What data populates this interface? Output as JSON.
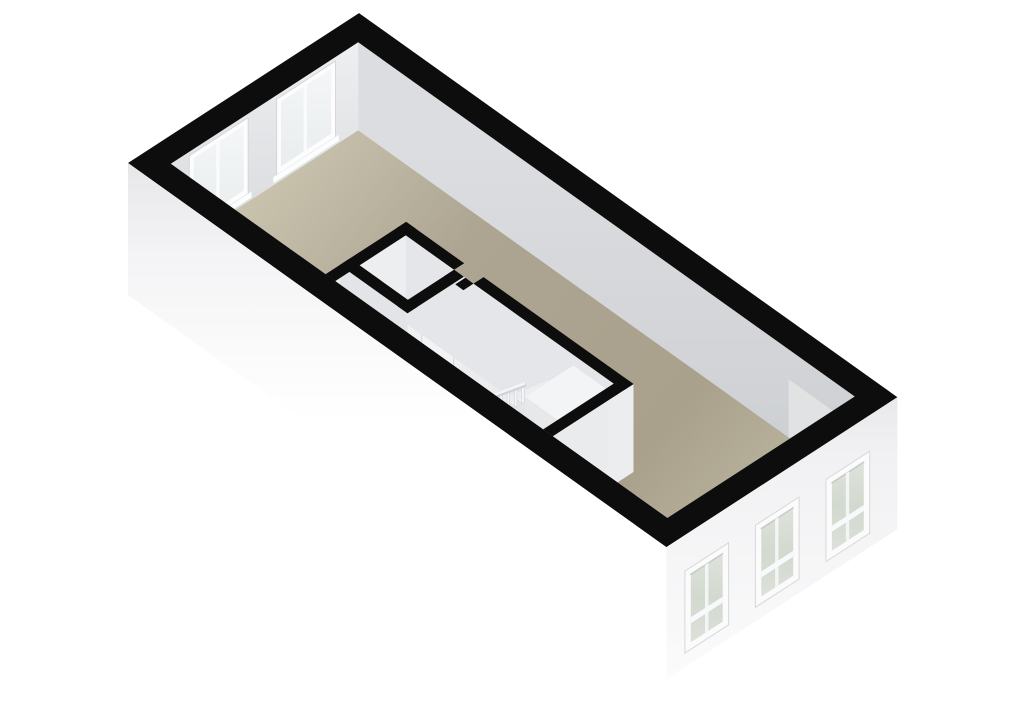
{
  "scene": {
    "kind": "floorplan-3d-render",
    "width": 1024,
    "height": 724,
    "background": "#ffffff",
    "colors": {
      "wall_cut_black": "#0d0d0d",
      "floor_tan": "#a9a18c",
      "floor_tan_light": "#cac4af",
      "interior_wall_light": "#eceef0",
      "interior_wall_shade": "#e2e4e7",
      "nw_face_top": "#eceef0",
      "nw_face_bottom": "#d7d9dc",
      "ne_face_top": "#dadcde",
      "ne_face_bottom": "#cdd0d3",
      "exterior_white": "#fbfbfc",
      "window_frame": "#fbfbfc",
      "glass_green": "#d3dad0",
      "glass_pale": "#f0f3f4",
      "stair_tread": "#f2f3f5",
      "stair_side": "#e3e5e8",
      "door_outline": "#c6c8cb"
    },
    "gradients": [
      {
        "id": "g_floor",
        "units": "userSpaceOnUse",
        "x1": 300,
        "y1": 120,
        "x2": 760,
        "y2": 500,
        "stops": [
          [
            0,
            "#cac4af"
          ],
          [
            0.35,
            "#ada592"
          ],
          [
            0.8,
            "#a9a18c"
          ],
          [
            1,
            "#b8b19c"
          ]
        ]
      },
      {
        "id": "g_nwface",
        "units": "userSpaceOnUse",
        "x1": 260,
        "y1": 50,
        "x2": 260,
        "y2": 250,
        "stops": [
          [
            0,
            "#eceef0"
          ],
          [
            1,
            "#d7d9dc"
          ]
        ]
      },
      {
        "id": "g_neface",
        "units": "userSpaceOnUse",
        "x1": 600,
        "y1": 150,
        "x2": 600,
        "y2": 490,
        "stops": [
          [
            0,
            "#dbdde0"
          ],
          [
            0.6,
            "#d2d4d7"
          ],
          [
            1,
            "#cbced1"
          ]
        ]
      },
      {
        "id": "g_swext",
        "units": "objectBoundingBox",
        "x1": 0,
        "y1": 0,
        "x2": 0,
        "y2": 1,
        "stops": [
          [
            0,
            "#e7e7e9"
          ],
          [
            0.18,
            "#f4f4f6"
          ],
          [
            0.5,
            "#ffffff"
          ],
          [
            1,
            "#ffffff"
          ]
        ]
      },
      {
        "id": "g_seext",
        "units": "objectBoundingBox",
        "x1": 0,
        "y1": 0,
        "x2": 0,
        "y2": 1,
        "stops": [
          [
            0,
            "#e9e9eb"
          ],
          [
            0.2,
            "#f1f1f3"
          ],
          [
            0.7,
            "#f7f7f8"
          ],
          [
            1,
            "#fbfbfc"
          ]
        ]
      },
      {
        "id": "g_glass",
        "units": "objectBoundingBox",
        "x1": 0,
        "y1": 0,
        "x2": 0,
        "y2": 1,
        "stops": [
          [
            0,
            "#dee3db"
          ],
          [
            0.5,
            "#d2d9cf"
          ],
          [
            1,
            "#dce1d9"
          ]
        ]
      },
      {
        "id": "g_nwglass",
        "units": "objectBoundingBox",
        "x1": 0,
        "y1": 0,
        "x2": 0,
        "y2": 1,
        "stops": [
          [
            0,
            "#f4f6f7"
          ],
          [
            1,
            "#e9edee"
          ]
        ]
      }
    ],
    "elements": [
      {
        "name": "background",
        "type": "polygon",
        "points": "0,0 1024,0 1024,724 0,724",
        "fill": "#ffffff"
      },
      {
        "name": "interior-face-nw-wall",
        "type": "polygon",
        "points": "170.8,163.8 358.2,42.3 358.2,130.3 170.8,251.8",
        "fill": "url(#g_nwface)"
      },
      {
        "name": "window-nw-1-frame",
        "type": "polygon",
        "points": "189.3,155.8 248.1,117.7 248.1,193.7 189.3,231.8",
        "fill": "#fdfdfe",
        "stroke": "#cfd2d4",
        "sw": 0.8
      },
      {
        "name": "window-nw-1-glass",
        "type": "polygon",
        "points": "193.5,158.1 243.9,125.4 243.9,190.4 193.5,223.1",
        "fill": "url(#g_nwglass)"
      },
      {
        "name": "window-nw-1-divider",
        "type": "polygon",
        "points": "216.2,143.4 219.6,141.2 219.6,206.2 216.2,208.4",
        "fill": "#fafbfc"
      },
      {
        "name": "window-nw-1-sill",
        "type": "polygon",
        "points": "186,234 251.5,191.5 251.5,197.5 186,240",
        "fill": "#fcfdfd"
      },
      {
        "name": "window-nw-2-frame",
        "type": "polygon",
        "points": "276.7,99.2 335.5,61 335.5,137 276.7,175.2",
        "fill": "#fdfdfe",
        "stroke": "#cfd2d4",
        "sw": 0.8
      },
      {
        "name": "window-nw-2-glass",
        "type": "polygon",
        "points": "280.9,101.4 331.3,68.7 331.3,133.7 280.9,166.4",
        "fill": "url(#g_nwglass)"
      },
      {
        "name": "window-nw-2-divider",
        "type": "polygon",
        "points": "303.6,86.7 306.9,84.6 306.9,149.6 303.6,151.7",
        "fill": "#fafbfc"
      },
      {
        "name": "window-nw-2-sill",
        "type": "polygon",
        "points": "273.3,177.3 338.8,134.8 338.8,140.8 273.3,183.3",
        "fill": "#fcfdfd"
      },
      {
        "name": "interior-face-ne-wall",
        "type": "polygon",
        "points": "358.2,42.3 854.7,396.5 854.7,484.5 358.2,130.3",
        "fill": "url(#g_neface)"
      },
      {
        "name": "ne-wall-light-patch",
        "type": "polygon",
        "points": "788.6,379.3 854.7,426.5 854.7,484.5 788.6,441.3",
        "fill": "#eef0ee",
        "opacity": 0.55
      },
      {
        "name": "floor-main",
        "type": "polygon",
        "points": "235.4,209.9 358.2,130.3 790.1,438.4 667.3,518",
        "fill": "url(#g_floor)"
      },
      {
        "name": "floor-interior-rooms",
        "type": "polygon",
        "points": "399.8,327.2 415.9,316.8 633.5,472 552.8,436.3",
        "fill": "#ececee"
      },
      {
        "name": "floor-closet",
        "type": "polygon",
        "points": "359.6,353.3 405.8,323.3 454.1,357.8 407.9,387.8",
        "fill": "#f0f0f2"
      },
      {
        "name": "hallway-end-wall-face",
        "type": "polygon",
        "points": "335.2,281.1 415.9,228.8 415.9,316.8 335.2,369.1",
        "fill": "#eceef0"
      },
      {
        "name": "hallway-side-wall-face",
        "type": "polygon",
        "points": "339.8,265 407.5,313.3 407.5,401.3 339.8,353",
        "fill": "#e2e4e7"
      },
      {
        "name": "hallway-door",
        "type": "polygon",
        "points": "357.5,297.6 388.2,319.5 388.2,387.5 357.5,365.6",
        "fill": "#eef0f2",
        "stroke": "#c6c8cb",
        "sw": 0.9
      },
      {
        "name": "closet-se-wall-face",
        "type": "polygon",
        "points": "407.5,313.3 463.8,276.7 463.8,364.7 407.5,401.3",
        "fill": "#eef0f1"
      },
      {
        "name": "closet-door",
        "type": "polygon",
        "points": "421.8,326 453.7,305.3 453.7,371.3 421.8,392",
        "fill": "#f2f3f5",
        "stroke": "#ccced1",
        "sw": 0.8
      },
      {
        "name": "partition-ne-wall-face",
        "type": "polygon",
        "points": "405.8,235.3 613.7,383.6 613.7,471.6 405.8,323.3",
        "fill": "#e4e6e9"
      },
      {
        "name": "stairwell-se-wall-face",
        "type": "polygon",
        "points": "552.8,436.3 633.5,384 633.5,472 552.8,524.3",
        "fill": "#ebedef"
      },
      {
        "name": "stairwell-door",
        "type": "polygon",
        "points": "564.6,454.7 596.5,434 596.5,496 564.6,516.7",
        "fill": "#f0f1f3",
        "stroke": "#c6c8cb",
        "sw": 0.9
      },
      {
        "name": "stair-step-1-side",
        "type": "polygon",
        "points": "481.2,413.5 488.5,418.7 488.5,448.7 481.2,443.5",
        "fill": "#e3e5e8"
      },
      {
        "name": "stair-step-1-top",
        "type": "polygon",
        "points": "481.2,413.5 511.4,393.8 518.7,399 488.5,418.7",
        "fill": "#f2f3f5",
        "stroke": "#dcdee1",
        "sw": 0.5
      },
      {
        "name": "stair-step-2-side",
        "type": "polygon",
        "points": "488.5,410.7 495.7,415.9 495.7,453.9 488.5,448.7",
        "fill": "#e3e5e8"
      },
      {
        "name": "stair-step-2-top",
        "type": "polygon",
        "points": "488.5,410.7 518.7,391 526,396.2 495.7,415.9",
        "fill": "#f2f3f5",
        "stroke": "#dcdee1",
        "sw": 0.5
      },
      {
        "name": "stair-step-3-side",
        "type": "polygon",
        "points": "495.7,407.9 503,413 503,459 495.7,453.9",
        "fill": "#e3e5e8"
      },
      {
        "name": "stair-step-3-top",
        "type": "polygon",
        "points": "495.7,407.9 525.9,388.2 533.2,393.3 503,413",
        "fill": "#f2f3f5",
        "stroke": "#dcdee1",
        "sw": 0.5
      },
      {
        "name": "stair-step-4-side",
        "type": "polygon",
        "points": "503,405 510.2,410.2 510.2,464.2 503,459",
        "fill": "#e3e5e8"
      },
      {
        "name": "stair-step-4-top",
        "type": "polygon",
        "points": "503,405 533.2,385.3 540.4,390.5 510.2,410.2",
        "fill": "#f2f3f5",
        "stroke": "#dcdee1",
        "sw": 0.5
      },
      {
        "name": "stair-step-5-side",
        "type": "polygon",
        "points": "510.2,402.2 517.5,407.4 517.5,469.4 510.2,464.2",
        "fill": "#e3e5e8"
      },
      {
        "name": "stair-step-5-top",
        "type": "polygon",
        "points": "510.2,402.2 540.4,382.5 547.7,387.7 517.5,407.4",
        "fill": "#f2f3f5",
        "stroke": "#dcdee1",
        "sw": 0.5
      },
      {
        "name": "stair-step-6-side",
        "type": "polygon",
        "points": "517.5,399.4 524.7,404.6 524.7,474.6 517.5,469.4",
        "fill": "#e3e5e8"
      },
      {
        "name": "stair-step-6-top",
        "type": "polygon",
        "points": "517.5,399.4 547.7,379.7 554.9,384.9 524.7,404.6",
        "fill": "#f2f3f5",
        "stroke": "#dcdee1",
        "sw": 0.5
      },
      {
        "name": "stair-baluster-1",
        "type": "polygon",
        "points": "478.3,400.5 480.7,400.5 480.7,420.5 478.3,420.5",
        "fill": "#f4f5f7",
        "stroke": "#c9ccd0",
        "sw": 0.5
      },
      {
        "name": "stair-baluster-2",
        "type": "polygon",
        "points": "485.6,397.7 488,397.7 488,417.7 485.6,417.7",
        "fill": "#f4f5f7",
        "stroke": "#c9ccd0",
        "sw": 0.5
      },
      {
        "name": "stair-baluster-3",
        "type": "polygon",
        "points": "492.8,394.9 495.2,394.9 495.2,414.9 492.8,414.9",
        "fill": "#f4f5f7",
        "stroke": "#c9ccd0",
        "sw": 0.5
      },
      {
        "name": "stair-baluster-4",
        "type": "polygon",
        "points": "500.1,392 502.5,392 502.5,412 500.1,412",
        "fill": "#f4f5f7",
        "stroke": "#c9ccd0",
        "sw": 0.5
      },
      {
        "name": "stair-baluster-5",
        "type": "polygon",
        "points": "507.3,389.2 509.7,389.2 509.7,409.2 507.3,409.2",
        "fill": "#f4f5f7",
        "stroke": "#c9ccd0",
        "sw": 0.5
      },
      {
        "name": "stair-baluster-6",
        "type": "polygon",
        "points": "514.6,386.4 517,386.4 517,406.4 514.6,406.4",
        "fill": "#f4f5f7",
        "stroke": "#c9ccd0",
        "sw": 0.5
      },
      {
        "name": "stair-baluster-7",
        "type": "polygon",
        "points": "521.8,383.6 524.2,383.6 524.2,403.6 521.8,403.6",
        "fill": "#f4f5f7",
        "stroke": "#c9ccd0",
        "sw": 0.5
      },
      {
        "name": "stair-handrail-shadow",
        "type": "polyline",
        "points": "478.5,401.5 524,384.6",
        "stroke": "#cdd0d4",
        "sw": 5
      },
      {
        "name": "stair-handrail",
        "type": "polyline",
        "points": "478.5,400.5 524,383.6",
        "stroke": "#f3f4f6",
        "sw": 3
      },
      {
        "name": "stair-landing-sw-face",
        "type": "polygon",
        "points": "524.6,396.7 558.5,420.9 558.5,500.9 524.6,476.7",
        "fill": "#e6e8ea"
      },
      {
        "name": "stair-landing-se-face",
        "type": "polygon",
        "points": "558.5,420.9 607.2,389.3 607.2,469.3 558.5,500.9",
        "fill": "#e9ebed"
      },
      {
        "name": "stair-landing-top",
        "type": "polygon",
        "points": "524.6,396.7 573.3,365.1 607.2,389.3 558.5,420.9",
        "fill": "#f3f4f6",
        "stroke": "#dfe1e4",
        "sw": 0.5
      },
      {
        "name": "cap-hallway-end-wall",
        "type": "polygon",
        "points": "325.5,274.2 406.2,221.9 415.9,228.8 335.2,281.1",
        "fill": "#0d0d0d"
      },
      {
        "name": "cap-hallway-side-wall",
        "type": "polygon",
        "points": "339.8,265 349.9,258.4 417.6,306.7 407.5,313.3",
        "fill": "#0d0d0d"
      },
      {
        "name": "cap-closet-se-wall",
        "type": "polygon",
        "points": "397.8,306.4 454.1,269.8 463.8,276.7 407.5,313.3",
        "fill": "#0d0d0d"
      },
      {
        "name": "cap-partition-ne-wall-a",
        "type": "polygon",
        "points": "396.1,228.4 406.2,221.9 464.2,263.3 454.1,269.8",
        "fill": "#0d0d0d"
      },
      {
        "name": "cap-partition-ne-wall-b",
        "type": "polygon",
        "points": "473.5,283.6 483.6,277.1 633.5,384 623.4,390.5",
        "fill": "#0d0d0d"
      },
      {
        "name": "cap-door-stub-1",
        "type": "polygon",
        "points": "444,276.4 454.1,269.8 462.2,275.6 452.1,282.2",
        "fill": "#0d0d0d"
      },
      {
        "name": "cap-door-stub-2",
        "type": "polygon",
        "points": "455.3,284.4 465.4,277.8 473.5,283.6 463.4,290.2",
        "fill": "#0d0d0d"
      },
      {
        "name": "cap-stairwell-se-wall",
        "type": "polygon",
        "points": "543.1,429.4 623.8,377.1 633.5,384 552.8,436.3",
        "fill": "#0d0d0d"
      },
      {
        "name": "cap-outer-wall-ring",
        "type": "path",
        "d": "M128,163 L359,13.1 L897.4,397.2 L666.4,547.1 Z M170.8,163.8 L667.3,518 L854.7,396.5 L358.2,42.3 Z",
        "fill": "#0d0d0d",
        "fillrule": "evenodd"
      },
      {
        "name": "cap-outer-sw-band-mask",
        "type": "polygon",
        "points": "277.1,269.4 666.4,547.1 667.3,518 298.9,255.2",
        "fill": "#0d0d0d"
      },
      {
        "name": "exterior-face-sw-wall",
        "type": "polygon",
        "points": "128,163 666.4,547.1 666.4,679.1 128,295.1",
        "fill": "url(#g_swext)"
      },
      {
        "name": "exterior-face-se-wall",
        "type": "polygon",
        "points": "897.4,397.2 666.4,547.1 666.4,679.1 897.4,529.2",
        "fill": "url(#g_seext)"
      },
      {
        "name": "window-se-1-frame",
        "type": "polygon",
        "points": "684.9,571.1 728.6,542.8 728.6,624.8 684.9,653.1",
        "fill": "#fbfbfc",
        "stroke": "#d7d8da",
        "sw": 1
      },
      {
        "name": "window-se-1-glass",
        "type": "polygon",
        "points": "690.8,574.3 722.7,553.6 722.7,621.6 690.8,642.3",
        "fill": "url(#g_glass)"
      },
      {
        "name": "window-se-1-glass-shadow",
        "type": "polyline",
        "points": "690.8,574.3 722.7,553.6",
        "stroke": "#a9afa7",
        "sw": 1.5,
        "opacity": 0.55
      },
      {
        "name": "window-se-1-divider",
        "type": "polygon",
        "points": "705,565 708.4,562.8 708.4,630.8 705,633",
        "fill": "#f6f7f8",
        "opacity": 0.9
      },
      {
        "name": "window-se-1-sash",
        "type": "polygon",
        "points": "690.8,617.3 722.7,596.6 722.7,602.6 690.8,623.3",
        "fill": "#f8f9fa"
      },
      {
        "name": "window-se-2-frame",
        "type": "polygon",
        "points": "755.4,525.3 799.1,497 799.1,579 755.4,607.3",
        "fill": "#fbfbfc",
        "stroke": "#d7d8da",
        "sw": 1
      },
      {
        "name": "window-se-2-glass",
        "type": "polygon",
        "points": "761.3,528.5 793.2,507.8 793.2,575.8 761.3,596.5",
        "fill": "url(#g_glass)"
      },
      {
        "name": "window-se-2-glass-shadow",
        "type": "polyline",
        "points": "761.3,528.5 793.2,507.8",
        "stroke": "#a9afa7",
        "sw": 1.5,
        "opacity": 0.55
      },
      {
        "name": "window-se-2-divider",
        "type": "polygon",
        "points": "775.1,519.2 778.5,517 778.5,585 775.1,587.2",
        "fill": "#f6f7f8",
        "opacity": 0.9
      },
      {
        "name": "window-se-2-sash",
        "type": "polygon",
        "points": "761.3,571.5 793.2,550.8 793.2,556.8 761.3,577.5",
        "fill": "#f8f9fa"
      },
      {
        "name": "window-se-3-frame",
        "type": "polygon",
        "points": "826,479.5 869.7,451.2 869.7,533.2 826,561.5",
        "fill": "#fbfbfc",
        "stroke": "#d7d8da",
        "sw": 1
      },
      {
        "name": "window-se-3-glass",
        "type": "polygon",
        "points": "831.9,482.7 863.8,462 863.8,530 831.9,550.7",
        "fill": "url(#g_glass)"
      },
      {
        "name": "window-se-3-glass-shadow",
        "type": "polyline",
        "points": "831.9,482.7 863.8,462",
        "stroke": "#a9afa7",
        "sw": 1.5,
        "opacity": 0.55
      },
      {
        "name": "window-se-3-divider",
        "type": "polygon",
        "points": "845.8,473.4 849.2,471.2 849.2,539.2 845.8,541.4",
        "fill": "#f6f7f8",
        "opacity": 0.9
      },
      {
        "name": "window-se-3-sash",
        "type": "polygon",
        "points": "831.9,525.7 863.8,505 863.8,511 831.9,531.7",
        "fill": "#f8f9fa"
      }
    ]
  }
}
